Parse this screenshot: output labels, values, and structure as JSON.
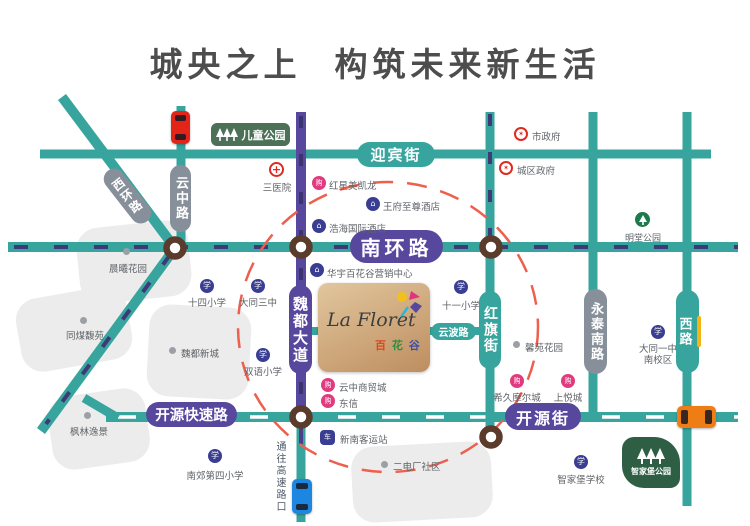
{
  "title": "城央之上  构筑未来新生活",
  "logo": {
    "name_en": "La Floret",
    "cn1": "百",
    "cn2": "花",
    "cn3": "谷"
  },
  "roads": {
    "yingbin": "迎宾街",
    "nanhuan": "南环路",
    "yunzhong": "云中路",
    "xihuan": "西环路",
    "weidu": "魏都大道",
    "hongqi": "红旗街",
    "yunbo": "云波路",
    "yongtai": "永泰南路",
    "xilu": "西路",
    "kaiyuan_express": "开源快速路",
    "kaiyuan_street": "开源街",
    "to_highway": "通往高速路口"
  },
  "parks": {
    "children": "儿童公园",
    "mingtang": "明堂公园",
    "zhijiabu": "智家堡公园"
  },
  "pois": {
    "sanyiyuan": "三医院",
    "hongxing": "红星美凯龙",
    "wangfu": "王府至尊酒店",
    "haohai": "浩海国际酒店",
    "huayu": "华宇百花谷营销中心",
    "shizhengfu": "市政府",
    "chengqu": "城区政府",
    "shisi": "十四小学",
    "datong3": "大同三中",
    "shiyi": "十一小学",
    "shuangyu": "双语小学",
    "yunzhong_mall": "云中商贸城",
    "dongxin": "东信",
    "xinnan": "新南客运站",
    "xijiu": "希久摩尔城",
    "shangyue": "上悦城",
    "zhijiabu_school": "智家堡学校",
    "nanjiao4": "南郊第四小学",
    "datong1": "大同一中",
    "datong1_campus": "南校区"
  },
  "residential": {
    "chenxi": "晨曦花园",
    "tongmei": "同煤馥苑",
    "weidu_xincheng": "魏都新城",
    "fenglin": "枫林逸景",
    "xinyuan": "馨苑花园",
    "erdianchang": "二电厂社区"
  },
  "icon_glyphs": {
    "school": "学",
    "building": "⌂",
    "mall": "购",
    "gov": "✶",
    "cross": "+",
    "bus": "车"
  },
  "colors": {
    "teal": "#37a59e",
    "purple": "#57489e",
    "graypill": "#87909a",
    "brown": "#5a3b2c",
    "navydash": "#3d3a78",
    "reddash": "#ee5f4d",
    "parkgreen": "#4c7157",
    "parkdark": "#2e5f45",
    "blueicon": "#3a3e92",
    "pinkicon": "#e23a7e",
    "redicon": "#e02a20",
    "greenicon": "#1d7a4a",
    "carred": "#e32519",
    "caryellow": "#f4b414",
    "carorange": "#ef7d16",
    "carblue": "#1d86e0",
    "logotan1": "#e2c69e",
    "logotan2": "#bd8e5f",
    "areagray": "#ececec",
    "label": "#5f6368"
  }
}
